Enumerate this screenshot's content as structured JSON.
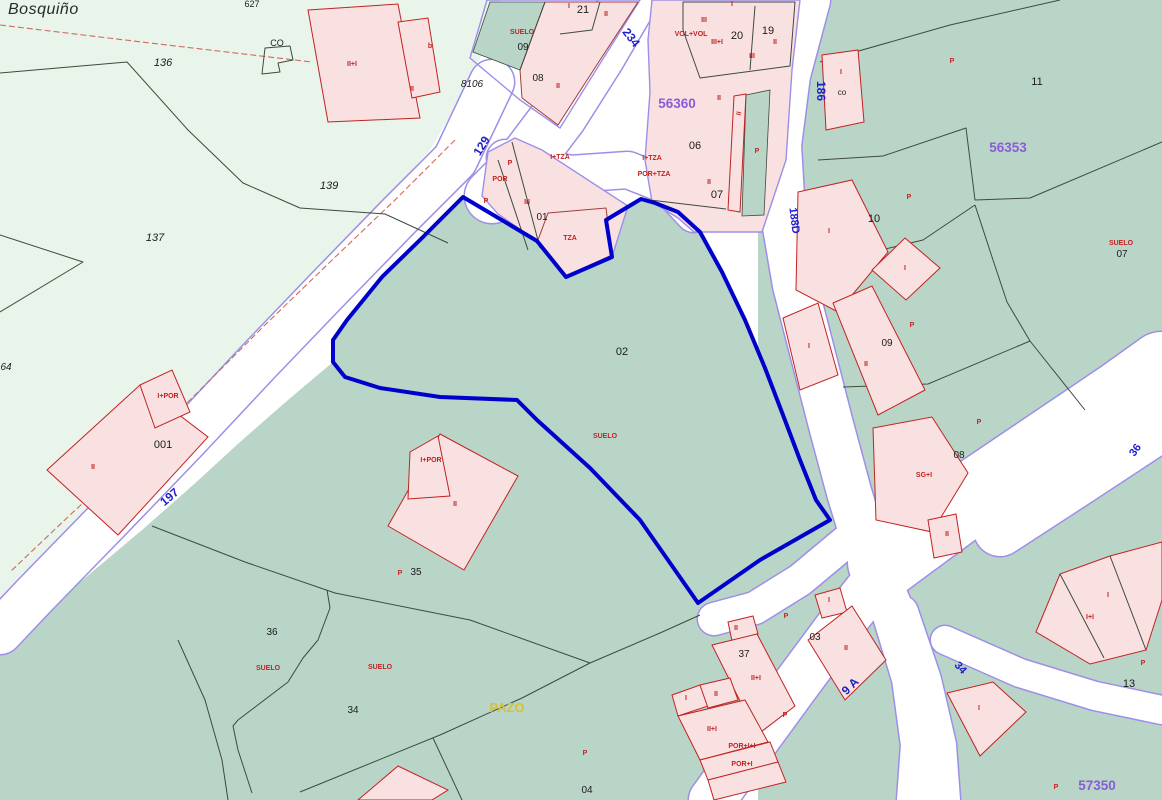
{
  "title": {
    "place_name": "Bosquiño"
  },
  "colors": {
    "selection_blue": "#0000cd",
    "teal": "#b9d5c7",
    "pale_green": "#e9f4ea",
    "building_fill": "#f9e1e1",
    "building_stroke": "#a23b3b",
    "road_edge": "#9d8fe8",
    "parcel_line": "#3d4b3d",
    "label_red": "#c22222",
    "label_blue": "#2020cc",
    "label_purple": "#8a5cd8",
    "label_yellow": "#d4c23c",
    "label_black": "#1c1c1c"
  },
  "labels": {
    "parcel_numbers": [
      {
        "t": "627",
        "x": 252,
        "y": 7,
        "s": 9
      },
      {
        "t": "CO",
        "x": 277,
        "y": 46,
        "s": 9
      },
      {
        "t": "136",
        "x": 163,
        "y": 66,
        "s": 11,
        "i": 1
      },
      {
        "t": "8106",
        "x": 472,
        "y": 87,
        "s": 10,
        "i": 1
      },
      {
        "t": "139",
        "x": 329,
        "y": 189,
        "s": 11,
        "i": 1
      },
      {
        "t": "137",
        "x": 155,
        "y": 241,
        "s": 11,
        "i": 1
      },
      {
        "t": "64",
        "x": 6,
        "y": 370,
        "s": 10,
        "i": 1
      },
      {
        "t": "001",
        "x": 163,
        "y": 448,
        "s": 11
      },
      {
        "t": "02",
        "x": 622,
        "y": 355,
        "s": 11
      },
      {
        "t": "09",
        "x": 523,
        "y": 50,
        "s": 10
      },
      {
        "t": "08",
        "x": 538,
        "y": 81,
        "s": 10
      },
      {
        "t": "21",
        "x": 583,
        "y": 13,
        "s": 11
      },
      {
        "t": "20",
        "x": 737,
        "y": 39,
        "s": 11
      },
      {
        "t": "19",
        "x": 768,
        "y": 34,
        "s": 11
      },
      {
        "t": "06",
        "x": 695,
        "y": 149,
        "s": 11
      },
      {
        "t": "07",
        "x": 717,
        "y": 198,
        "s": 11
      },
      {
        "t": "01",
        "x": 542,
        "y": 220,
        "s": 10
      },
      {
        "t": "co",
        "x": 842,
        "y": 95,
        "s": 8
      },
      {
        "t": "11",
        "x": 1037,
        "y": 85,
        "s": 11
      },
      {
        "t": "10",
        "x": 874,
        "y": 222,
        "s": 11
      },
      {
        "t": "07",
        "x": 1122,
        "y": 257,
        "s": 10
      },
      {
        "t": "09",
        "x": 887,
        "y": 346,
        "s": 10
      },
      {
        "t": "08",
        "x": 959,
        "y": 458,
        "s": 10
      },
      {
        "t": "35",
        "x": 416,
        "y": 575,
        "s": 10
      },
      {
        "t": "36",
        "x": 272,
        "y": 635,
        "s": 10
      },
      {
        "t": "34",
        "x": 353,
        "y": 713,
        "s": 10
      },
      {
        "t": "04",
        "x": 587,
        "y": 793,
        "s": 10
      },
      {
        "t": "37",
        "x": 744,
        "y": 657,
        "s": 10
      },
      {
        "t": "03",
        "x": 815,
        "y": 640,
        "s": 10
      },
      {
        "t": "13",
        "x": 1129,
        "y": 687,
        "s": 11
      }
    ],
    "building_codes": [
      {
        "t": "SUELO",
        "x": 522,
        "y": 34
      },
      {
        "t": "SUELO",
        "x": 605,
        "y": 438
      },
      {
        "t": "SUELO",
        "x": 268,
        "y": 670
      },
      {
        "t": "SUELO",
        "x": 380,
        "y": 669
      },
      {
        "t": "SUELO",
        "x": 1121,
        "y": 245
      },
      {
        "t": "b",
        "x": 430,
        "y": 48
      },
      {
        "t": "II+I",
        "x": 352,
        "y": 66
      },
      {
        "t": "II",
        "x": 412,
        "y": 91
      },
      {
        "t": "II",
        "x": 558,
        "y": 88
      },
      {
        "t": "I",
        "x": 569,
        "y": 8
      },
      {
        "t": "II",
        "x": 606,
        "y": 16
      },
      {
        "t": "I",
        "x": 732,
        "y": 6
      },
      {
        "t": "III",
        "x": 704,
        "y": 22
      },
      {
        "t": "VOL+VOL",
        "x": 691,
        "y": 36
      },
      {
        "t": "III+I",
        "x": 717,
        "y": 44
      },
      {
        "t": "III",
        "x": 752,
        "y": 58
      },
      {
        "t": "II",
        "x": 775,
        "y": 44
      },
      {
        "t": "II",
        "x": 719,
        "y": 100
      },
      {
        "t": "II",
        "x": 741,
        "y": 114,
        "r": -75
      },
      {
        "t": "P",
        "x": 757,
        "y": 153
      },
      {
        "t": "II",
        "x": 709,
        "y": 184
      },
      {
        "t": "I+TZA",
        "x": 560,
        "y": 159
      },
      {
        "t": "I+TZA",
        "x": 652,
        "y": 160
      },
      {
        "t": "POR+TZA",
        "x": 654,
        "y": 176
      },
      {
        "t": "P",
        "x": 510,
        "y": 165
      },
      {
        "t": "POR",
        "x": 500,
        "y": 181
      },
      {
        "t": "P",
        "x": 486,
        "y": 203
      },
      {
        "t": "III",
        "x": 527,
        "y": 204
      },
      {
        "t": "TZA",
        "x": 570,
        "y": 240
      },
      {
        "t": "P",
        "x": 952,
        "y": 63
      },
      {
        "t": "I",
        "x": 841,
        "y": 74
      },
      {
        "t": "I",
        "x": 829,
        "y": 233
      },
      {
        "t": "P",
        "x": 909,
        "y": 199
      },
      {
        "t": "I",
        "x": 905,
        "y": 270
      },
      {
        "t": "P",
        "x": 912,
        "y": 327
      },
      {
        "t": "I",
        "x": 809,
        "y": 348
      },
      {
        "t": "II",
        "x": 866,
        "y": 366
      },
      {
        "t": "P",
        "x": 979,
        "y": 424
      },
      {
        "t": "SG+I",
        "x": 924,
        "y": 477
      },
      {
        "t": "II",
        "x": 947,
        "y": 536
      },
      {
        "t": "I+POR",
        "x": 168,
        "y": 398
      },
      {
        "t": "II",
        "x": 93,
        "y": 469
      },
      {
        "t": "I+POR",
        "x": 431,
        "y": 462
      },
      {
        "t": "II",
        "x": 455,
        "y": 506
      },
      {
        "t": "P",
        "x": 400,
        "y": 575
      },
      {
        "t": "II",
        "x": 736,
        "y": 630
      },
      {
        "t": "II+I",
        "x": 756,
        "y": 680
      },
      {
        "t": "P",
        "x": 786,
        "y": 618
      },
      {
        "t": "I",
        "x": 829,
        "y": 602
      },
      {
        "t": "II",
        "x": 846,
        "y": 650
      },
      {
        "t": "I",
        "x": 686,
        "y": 700
      },
      {
        "t": "II",
        "x": 716,
        "y": 696
      },
      {
        "t": "II+I",
        "x": 712,
        "y": 731
      },
      {
        "t": "POR+I+I",
        "x": 742,
        "y": 748
      },
      {
        "t": "POR+I",
        "x": 742,
        "y": 766
      },
      {
        "t": "P",
        "x": 785,
        "y": 717
      },
      {
        "t": "P",
        "x": 585,
        "y": 755
      },
      {
        "t": "P",
        "x": 1143,
        "y": 665
      },
      {
        "t": "I+I",
        "x": 1090,
        "y": 619
      },
      {
        "t": "I",
        "x": 1108,
        "y": 597
      },
      {
        "t": "I",
        "x": 979,
        "y": 710
      },
      {
        "t": "P",
        "x": 1056,
        "y": 789
      }
    ],
    "road_names": [
      {
        "t": "129",
        "x": 485,
        "y": 148,
        "r": -58,
        "s": 12
      },
      {
        "t": "234",
        "x": 628,
        "y": 40,
        "r": 52,
        "s": 12
      },
      {
        "t": "186",
        "x": 817,
        "y": 91,
        "r": 90,
        "s": 12
      },
      {
        "t": "188D",
        "x": 791,
        "y": 221,
        "r": 83,
        "s": 11
      },
      {
        "t": "197",
        "x": 172,
        "y": 500,
        "r": -40,
        "s": 12
      },
      {
        "t": "9 A",
        "x": 853,
        "y": 689,
        "r": -45,
        "s": 12
      },
      {
        "t": "36",
        "x": 1138,
        "y": 452,
        "r": -55,
        "s": 11
      },
      {
        "t": "34",
        "x": 958,
        "y": 670,
        "r": 48,
        "s": 11
      }
    ],
    "zone_codes": [
      {
        "t": "56360",
        "x": 677,
        "y": 108
      },
      {
        "t": "56353",
        "x": 1008,
        "y": 152
      },
      {
        "t": "57350",
        "x": 1097,
        "y": 790
      }
    ],
    "landmarks": [
      {
        "t": "PAZO",
        "x": 507,
        "y": 712
      }
    ]
  }
}
